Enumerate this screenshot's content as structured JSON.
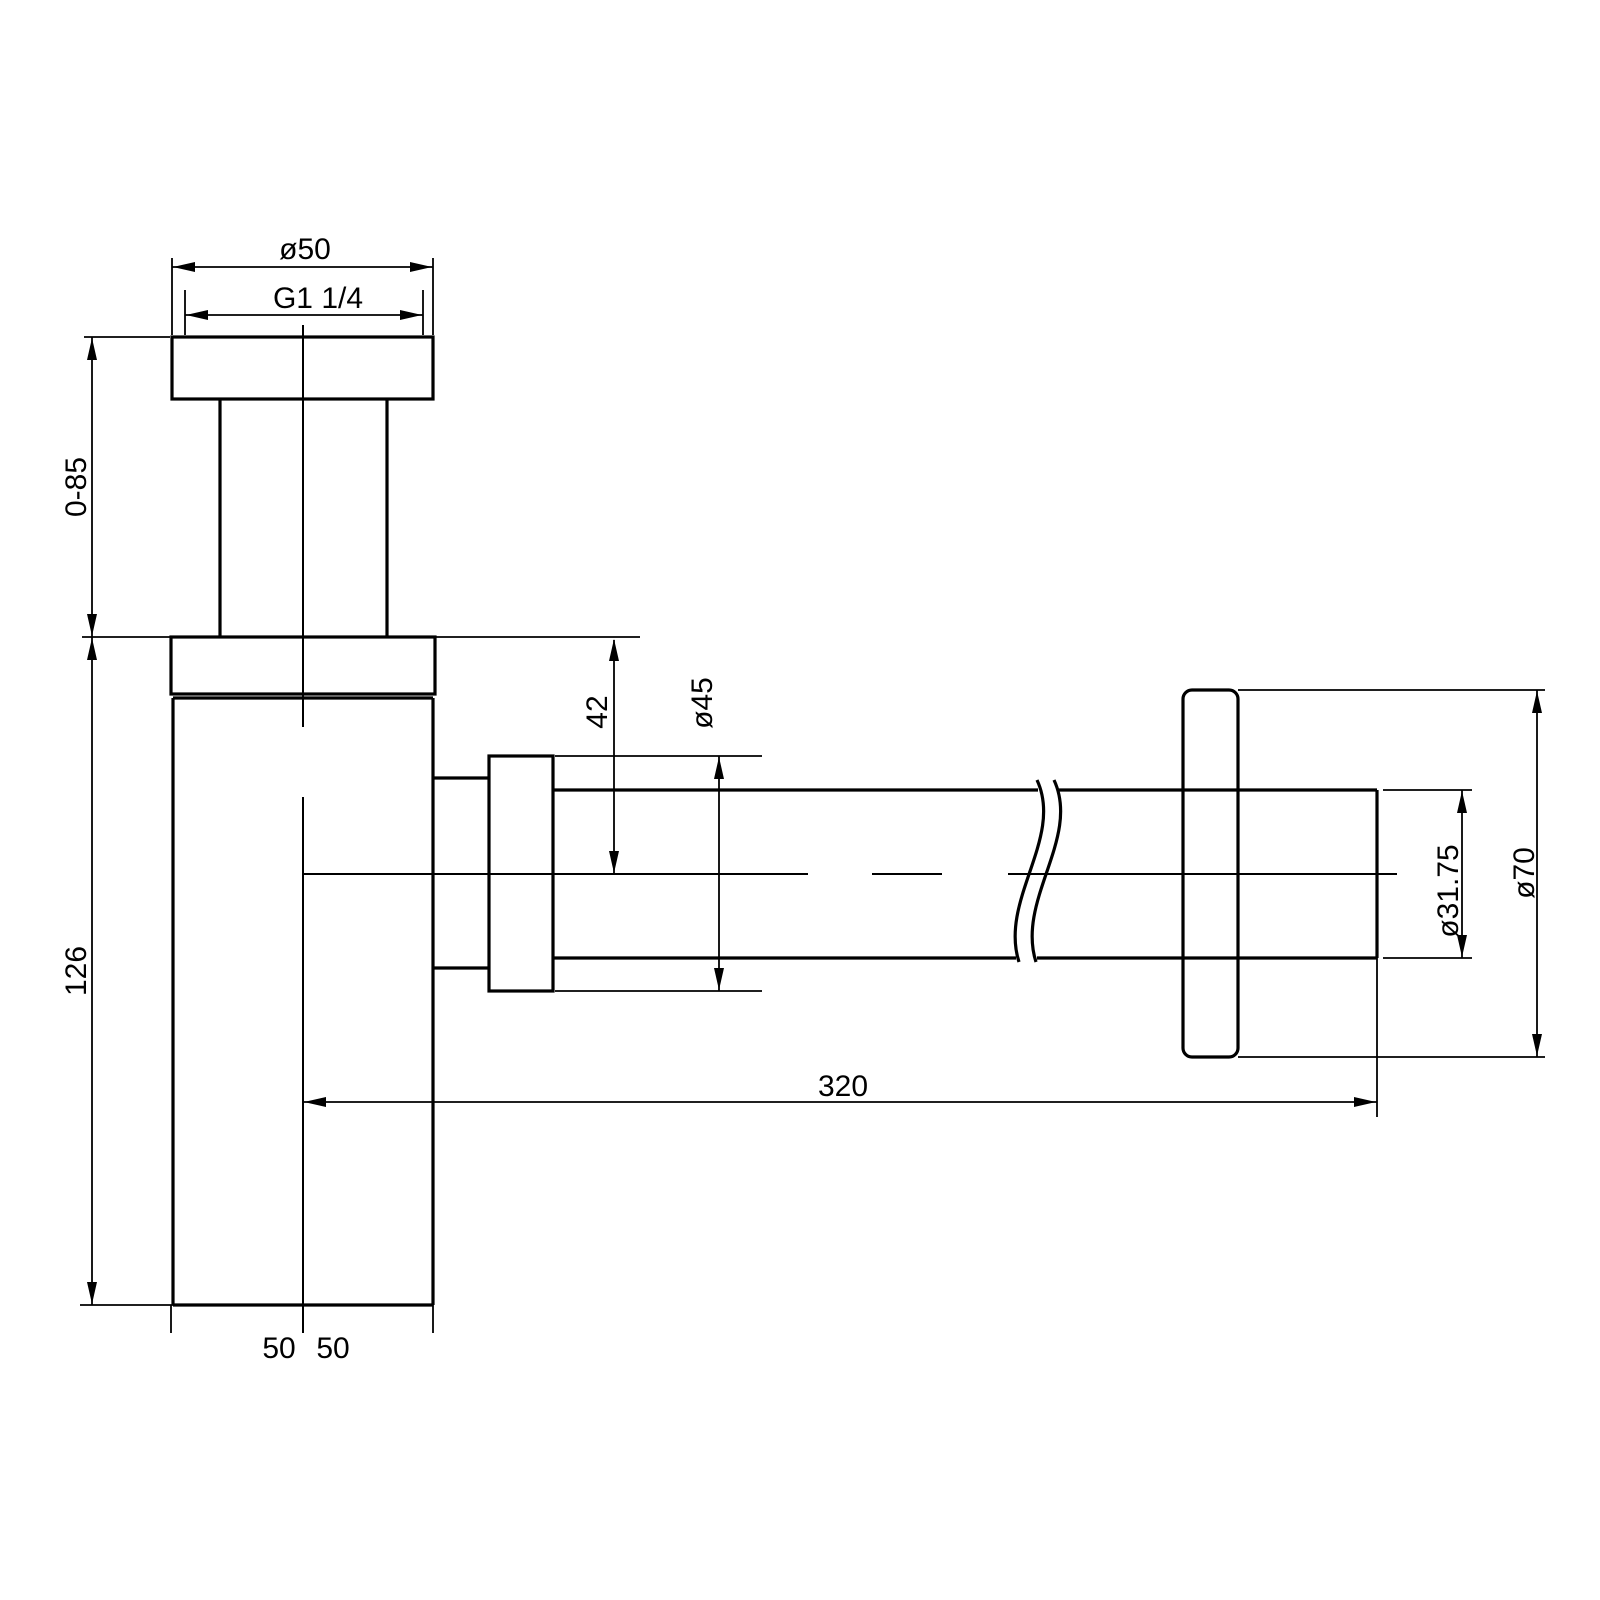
{
  "drawing": {
    "title": "bottle-trap-technical-drawing",
    "background_color": "#ffffff",
    "line_color": "#000000",
    "dimensions": {
      "top_flange_diameter": "ø50",
      "thread_size": "G1 1/4",
      "inlet_tube_adjustable_length": "0-85",
      "body_height": "126",
      "outlet_centre_drop": "42",
      "outlet_nut_diameter": "ø45",
      "pipe_diameter": "ø31.75",
      "wall_flange_diameter": "ø70",
      "pipe_length": "320",
      "bottom_half_width_left": "50",
      "bottom_half_width_right": "50"
    }
  }
}
